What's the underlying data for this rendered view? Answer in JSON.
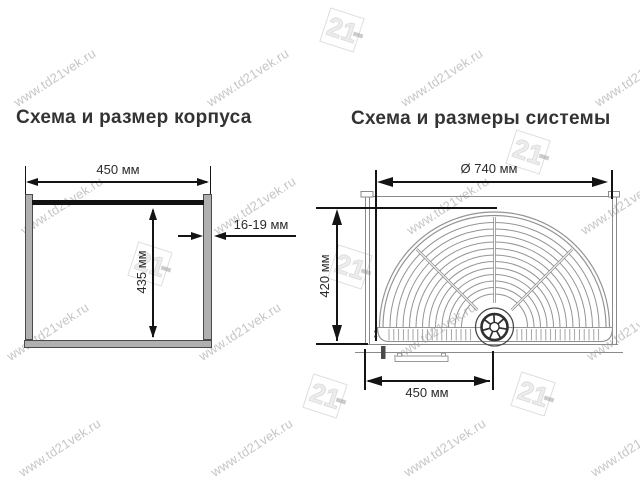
{
  "watermark": {
    "text": "www.td21vek.ru",
    "logo": "21",
    "text_color": "#c6c6c6",
    "logo_color": "#dedede"
  },
  "left_diagram": {
    "title": "Схема и размер корпуса",
    "width_label": "450 мм",
    "height_label": "435 мм",
    "thickness_label": "16-19 мм"
  },
  "right_diagram": {
    "title": "Схема и размеры системы",
    "diameter_label": "Ø 740 мм",
    "depth_label": "420 мм",
    "offset_label": "450 мм"
  },
  "colors": {
    "panel_fill": "#b0b0b0",
    "panel_border": "#4a4a4a",
    "top_rail": "#111111",
    "dimension_line": "#141414",
    "dimension_text": "#2b2b2b",
    "frame_line": "#8a8a8a",
    "title_text": "#333333"
  }
}
